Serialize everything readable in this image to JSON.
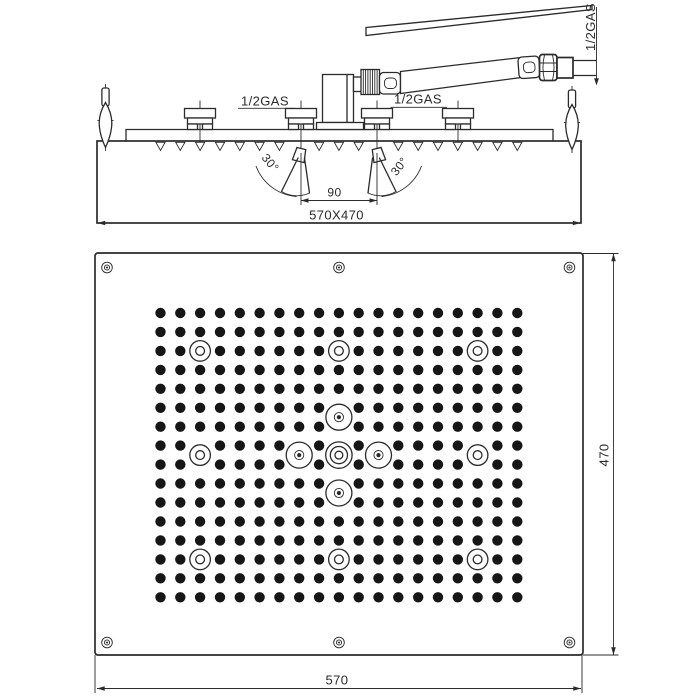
{
  "colors": {
    "line": "#2b2b2b",
    "background": "#ffffff",
    "dot": "#161616"
  },
  "side_view": {
    "labels": {
      "gas_arm": "1/2GAS",
      "gas_inlet_left": "1/2GAS",
      "gas_inlet_right": "1/2GAS",
      "angle_left": "30°",
      "angle_right": "30°",
      "nozzle_spacing": "90",
      "overall_size": "570X470"
    },
    "bracket_x": [
      200,
      301,
      377,
      458
    ],
    "spray_nozzle_x": [
      301,
      377
    ]
  },
  "bottom_view": {
    "labels": {
      "width": "570",
      "height": "470"
    },
    "panel": {
      "x": 95,
      "y": 253,
      "w": 488,
      "h": 402
    },
    "screws": [
      [
        107,
        267.5
      ],
      [
        339,
        267.5
      ],
      [
        569.5,
        267.5
      ],
      [
        107,
        642.5
      ],
      [
        339,
        642.5
      ],
      [
        569.5,
        642.5
      ]
    ],
    "grid": {
      "cols": 19,
      "rows": 16,
      "x0": 160.5,
      "y0": 313,
      "dx": 19.82,
      "dy": 18.95,
      "dot_r": 5.2,
      "removed": [
        [
          2,
          2
        ],
        [
          9,
          2
        ],
        [
          16,
          2
        ],
        [
          9,
          5
        ],
        [
          9,
          6
        ],
        [
          2,
          7
        ],
        [
          7,
          7
        ],
        [
          9,
          7
        ],
        [
          11,
          7
        ],
        [
          16,
          7
        ],
        [
          2,
          8
        ],
        [
          7,
          8
        ],
        [
          9,
          8
        ],
        [
          11,
          8
        ],
        [
          16,
          8
        ],
        [
          9,
          9
        ],
        [
          9,
          10
        ],
        [
          2,
          13
        ],
        [
          9,
          13
        ],
        [
          16,
          13
        ]
      ]
    },
    "open_ring_nozzles": [
      [
        200.1,
        350.9
      ],
      [
        338.9,
        350.9
      ],
      [
        477.6,
        350.9
      ],
      [
        200.1,
        455.1
      ],
      [
        477.6,
        455.1
      ],
      [
        200.1,
        559.4
      ],
      [
        338.9,
        559.4
      ],
      [
        477.6,
        559.4
      ]
    ],
    "ring_dot_nozzles": [
      [
        338.9,
        417.2
      ],
      [
        299.2,
        455.1
      ],
      [
        378.5,
        455.1
      ],
      [
        338.9,
        493
      ]
    ],
    "center_nozzle": [
      338.9,
      455.1
    ]
  }
}
